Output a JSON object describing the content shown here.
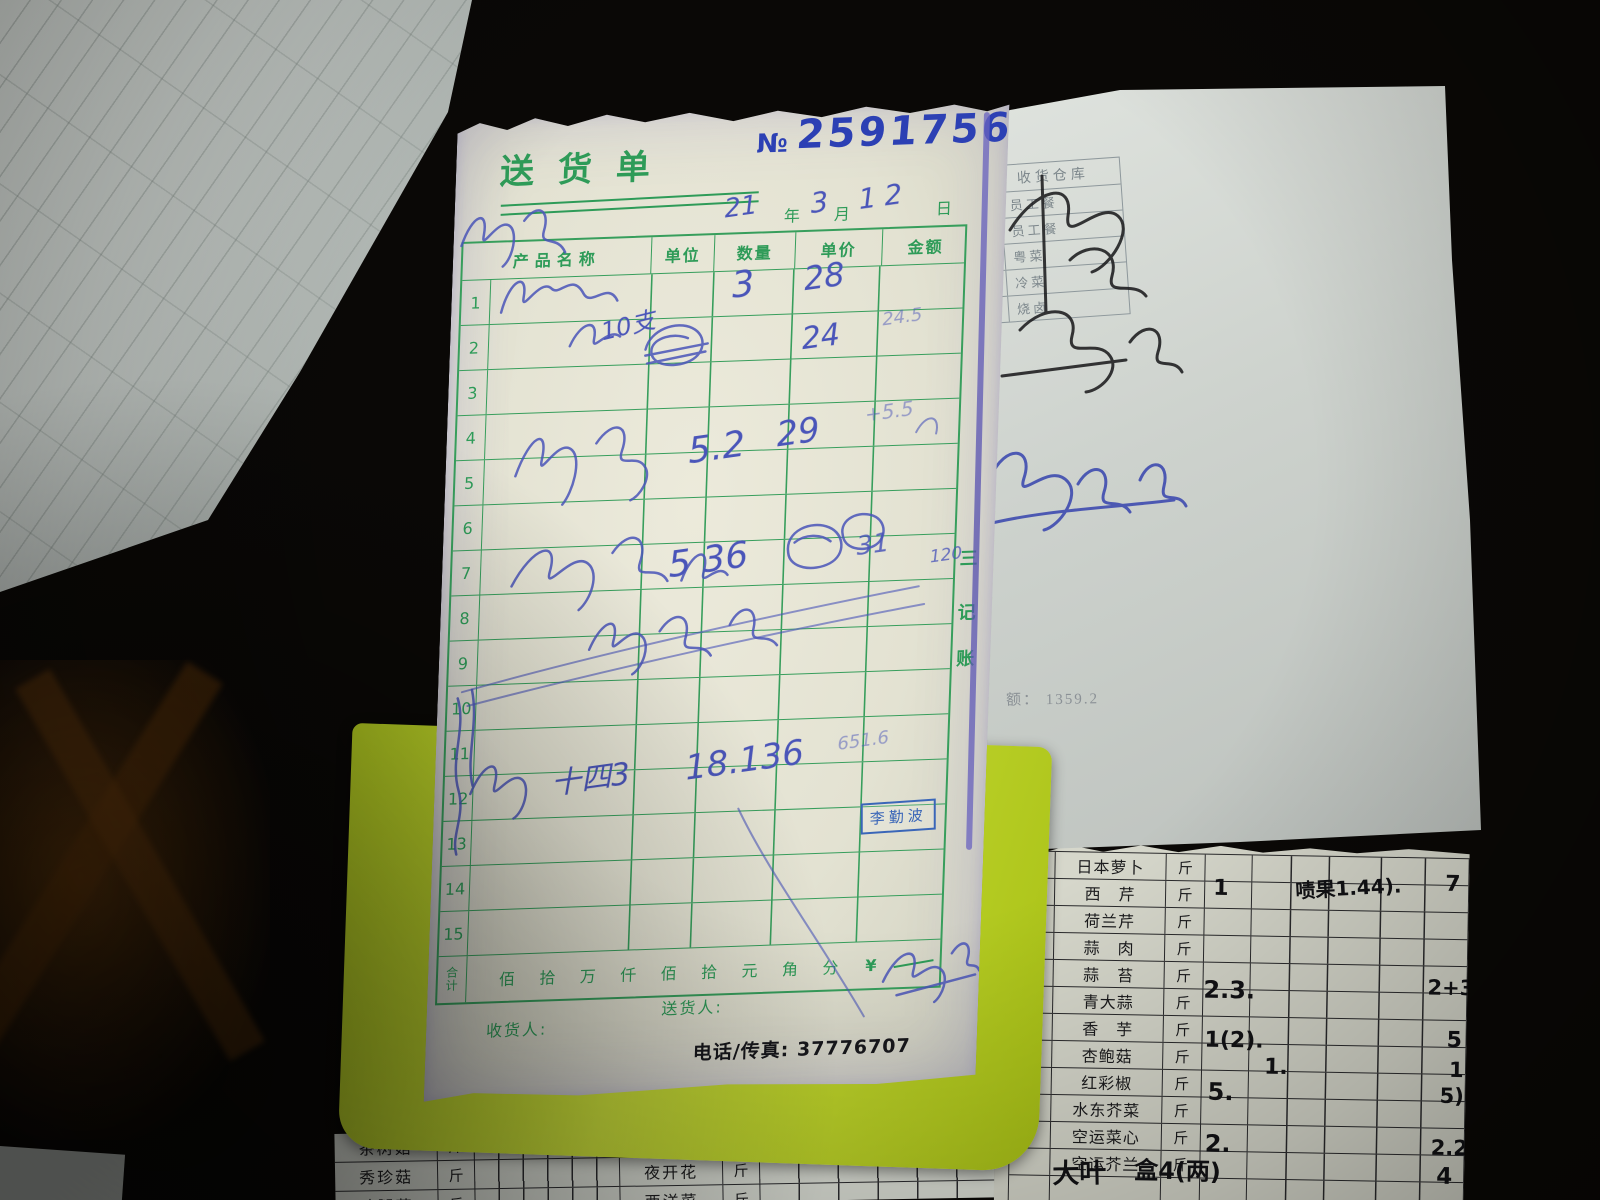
{
  "palette": {
    "note_green": "#2e9b58",
    "ink_blue": "#4a55b9",
    "number_blue": "#2c40b4",
    "stamp_blue": "#3a66b8",
    "yellow_sheet": "#c3d82e"
  },
  "delivery_note": {
    "title": "送货单",
    "no_label": "№",
    "no_value": "2591756",
    "date": {
      "year_hw": "21",
      "year_label": "年",
      "month_hw": "3",
      "month_label": "月",
      "day_hw": "12",
      "day_label": "日"
    },
    "table": {
      "headers": [
        "产品名称",
        "单位",
        "数量",
        "单价",
        "金额"
      ],
      "row_numbers": [
        "1",
        "2",
        "3",
        "4",
        "5",
        "6",
        "7",
        "8",
        "9",
        "10",
        "11",
        "12",
        "13",
        "14",
        "15"
      ]
    },
    "copy_label": {
      "c0": "三",
      "c1": "记",
      "c2": "账"
    },
    "total": {
      "label_top": "合",
      "label_bottom": "计",
      "units": [
        "佰",
        "拾",
        "万",
        "仟",
        "佰",
        "拾",
        "元",
        "角",
        "分"
      ],
      "currency": "¥"
    },
    "receiver_label": "收货人:",
    "deliverer_label": "送货人:",
    "phone_line": "电话/传真: 37776707",
    "stamp": "李勤波",
    "handwriting": {
      "r1_qty": "3",
      "r1_price": "28",
      "r2_name": "10支",
      "r2_price": "24",
      "r2_amount": "24.5",
      "r5_qty": "5.2",
      "r5_price": "29",
      "r5_amount": "+5.5",
      "r7_qty": "5 36",
      "r7_price": "31",
      "r7_amount": "120",
      "r12_name": "十四3",
      "r12_price": "18.136",
      "r12_amount": "651.6"
    }
  },
  "right_paper": {
    "warehouse": {
      "header": "收货仓库",
      "rows": [
        "员工餐",
        "员工餐",
        "粤菜",
        "冷菜",
        "烧卤"
      ]
    },
    "amount_note": "额：  1359.2"
  },
  "veg_table": {
    "rows": [
      {
        "m": "",
        "name": "日本萝卜",
        "unit": "斤",
        "qty": ""
      },
      {
        "m": "",
        "name": "西　芹",
        "unit": "斤",
        "qty": "1"
      },
      {
        "m": "",
        "name": "荷兰芹",
        "unit": "斤",
        "qty": ""
      },
      {
        "m": "",
        "name": "蒜　肉",
        "unit": "斤",
        "qty": ""
      },
      {
        "m": "1",
        "name": "蒜　苔",
        "unit": "斤",
        "qty": ""
      },
      {
        "m": "",
        "name": "青大蒜",
        "unit": "斤",
        "qty": "2.3."
      },
      {
        "m": "1.2",
        "name": "香　芋",
        "unit": "斤",
        "qty": ""
      },
      {
        "m": "",
        "name": "杏鲍菇",
        "unit": "斤",
        "qty": "1(2)."
      },
      {
        "m": "3.2",
        "name": "红彩椒",
        "unit": "斤",
        "qty": ""
      },
      {
        "m": "",
        "name": "水东芥菜",
        "unit": "斤",
        "qty": "5."
      },
      {
        "m": "10",
        "name": "空运菜心",
        "unit": "斤",
        "qty": ""
      },
      {
        "m": "",
        "name": "空运芥兰",
        "unit": "斤",
        "qty": "2."
      },
      {
        "m": "",
        "name": "",
        "unit": "",
        "qty": ""
      }
    ],
    "cell_note": "啧果1.44).",
    "red_pepper_qty": "1.",
    "bottom_hw": {
      "name": "大叶",
      "qty": "盒4(两)"
    },
    "right_margin": [
      "7",
      "2+3",
      "5",
      "1",
      "5)",
      "2.2",
      "4"
    ]
  },
  "bottom_table": {
    "rows": [
      [
        "茶树菇",
        "斤",
        "黄雪菜",
        "斤"
      ],
      [
        "秀珍菇",
        "斤",
        "夜开花",
        "斤"
      ],
      [
        "鸡腿菇",
        "斤",
        "西洋菜",
        "斤"
      ]
    ]
  }
}
